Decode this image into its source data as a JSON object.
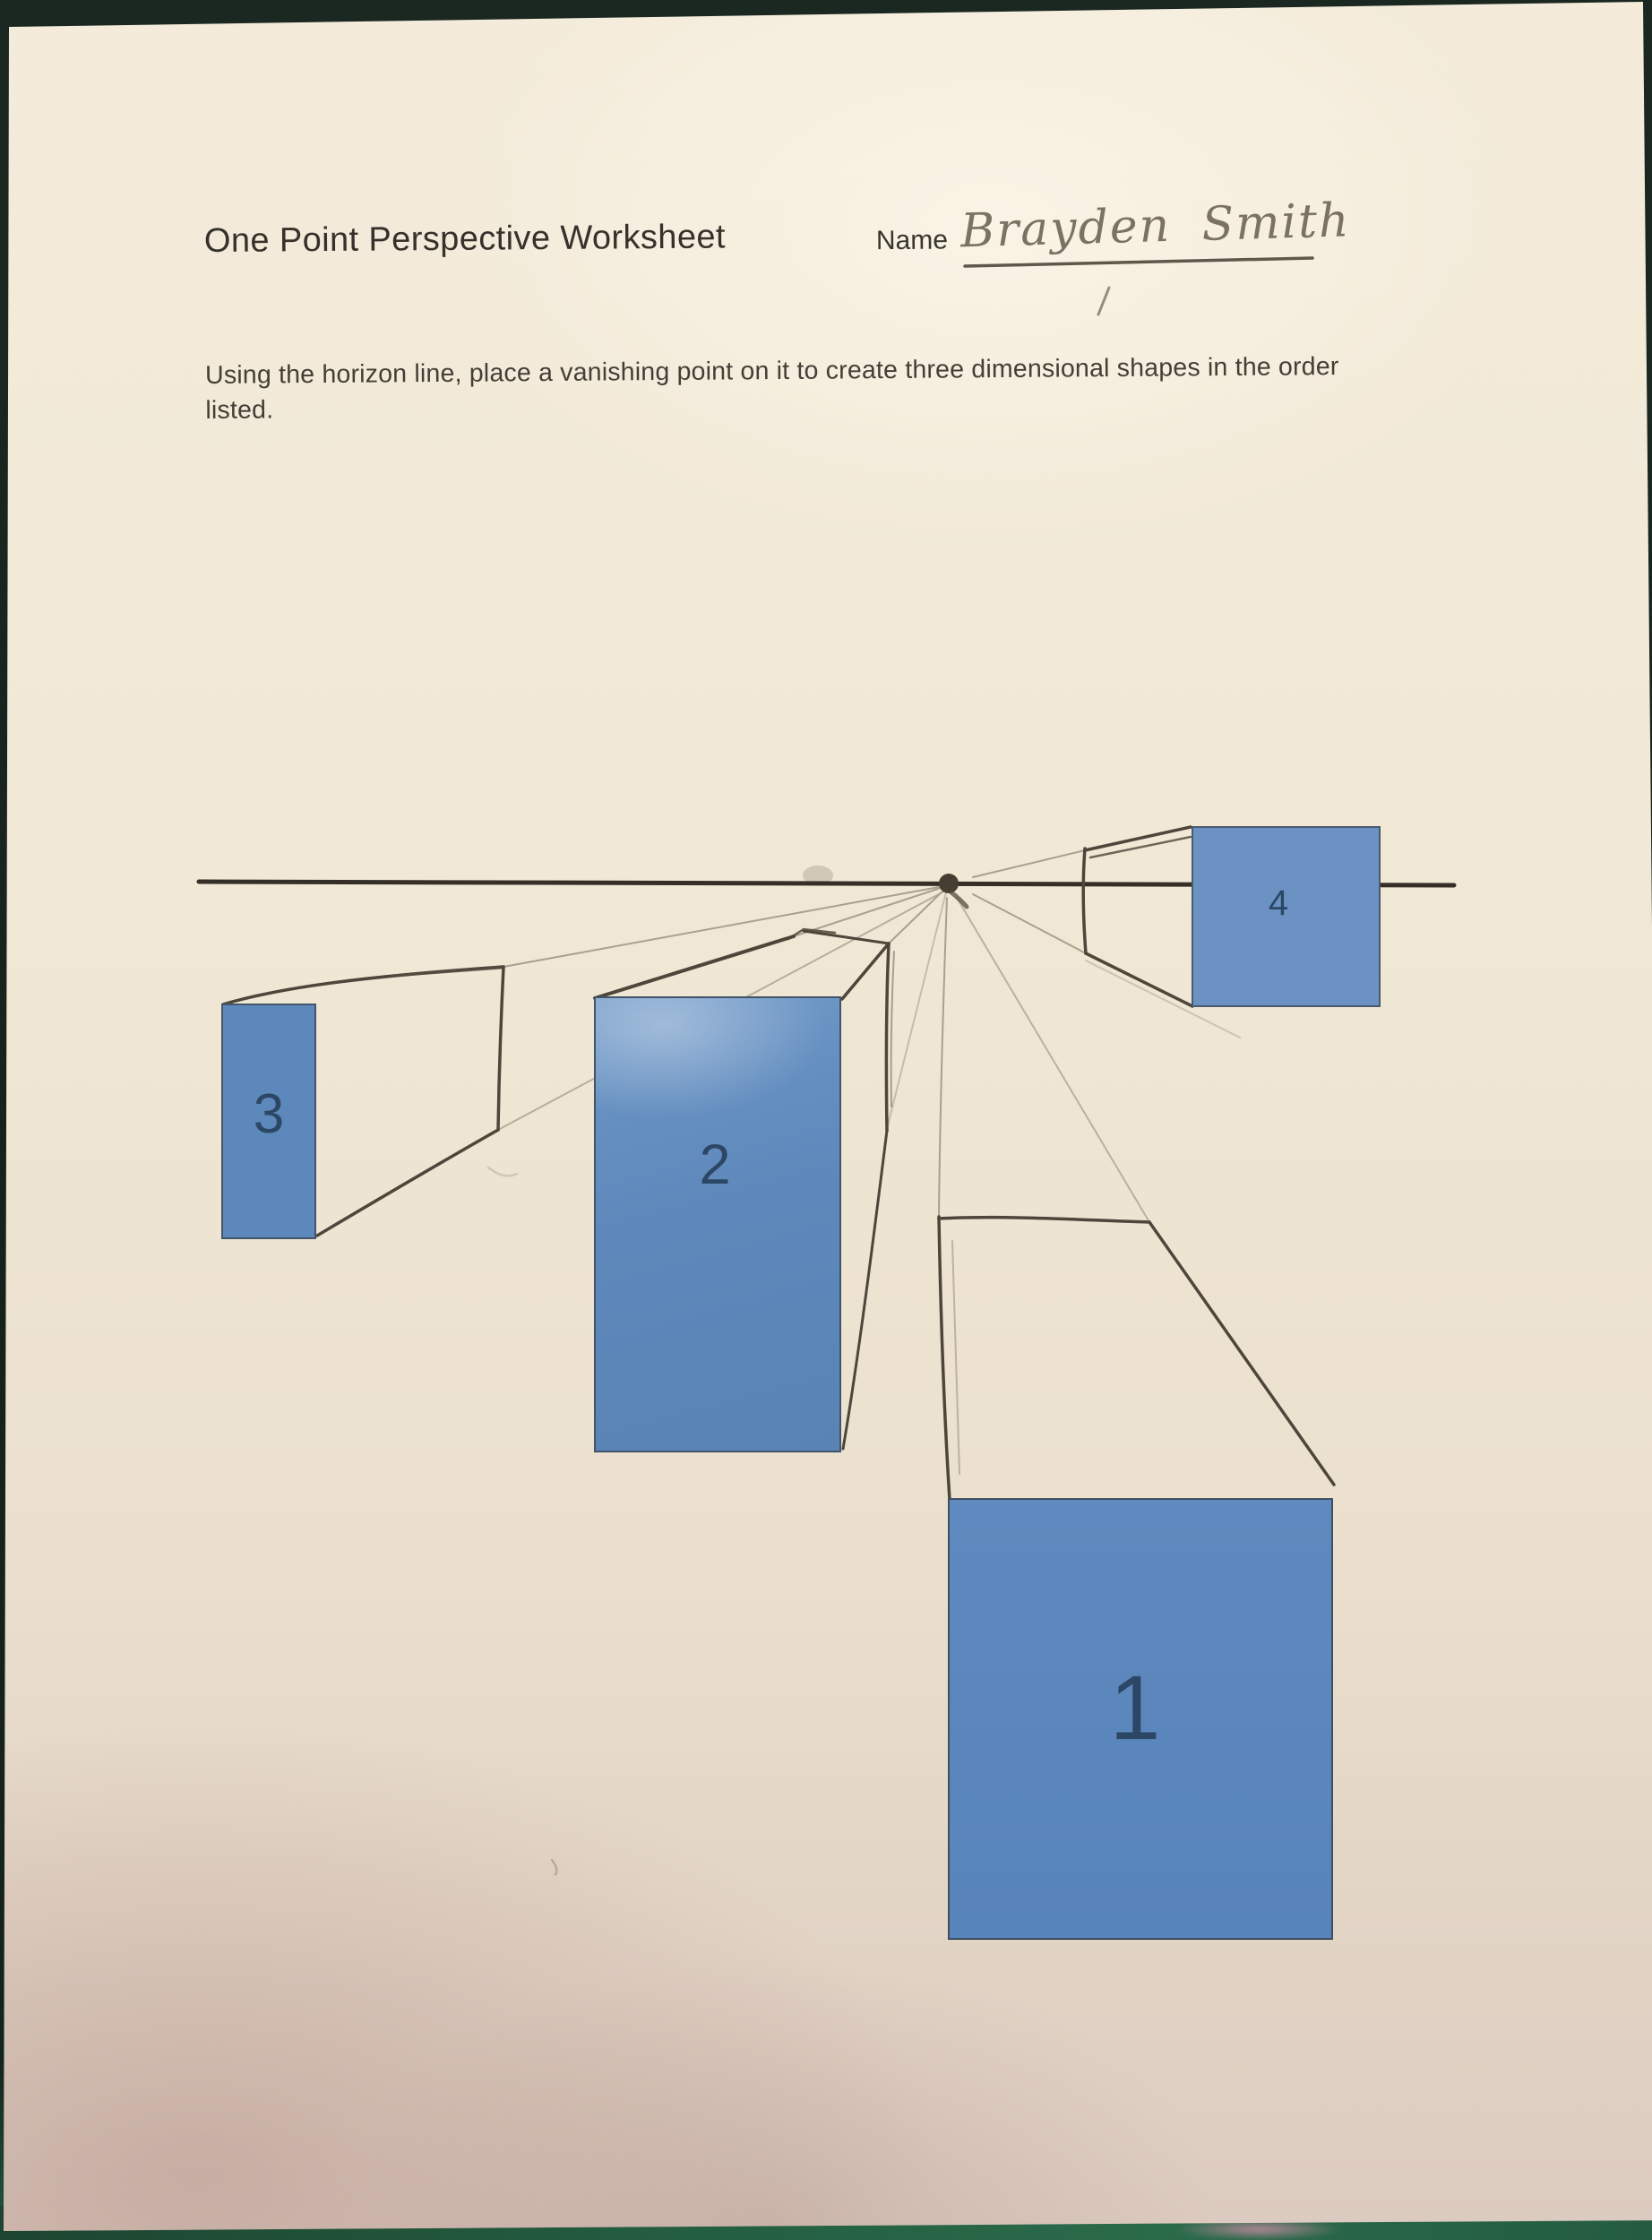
{
  "worksheet": {
    "title": "One Point Perspective Worksheet",
    "name_label": "Name",
    "student_name": "Brayden Smith",
    "instructions": [
      "Using the horizon line, place a vanishing point on it to create three dimensional shapes in the order",
      "listed."
    ],
    "boxes": [
      {
        "number": "1"
      },
      {
        "number": "2"
      },
      {
        "number": "3"
      },
      {
        "number": "4"
      }
    ]
  },
  "colors": {
    "paper": "#efe6d4",
    "backdrop_green": "#1b2822",
    "bottom_edge_green": "#2a6b4a",
    "pink_smear": "#c58ca1",
    "box_blue": "#5d88bc",
    "box_blue_light": "#6b92c2",
    "number_navy": "#2b4765",
    "pencil_dark": "#4e463a",
    "pencil_light": "#8c8274",
    "horizon_line": "#362f27",
    "handwriting_pencil": "#7b7263"
  }
}
